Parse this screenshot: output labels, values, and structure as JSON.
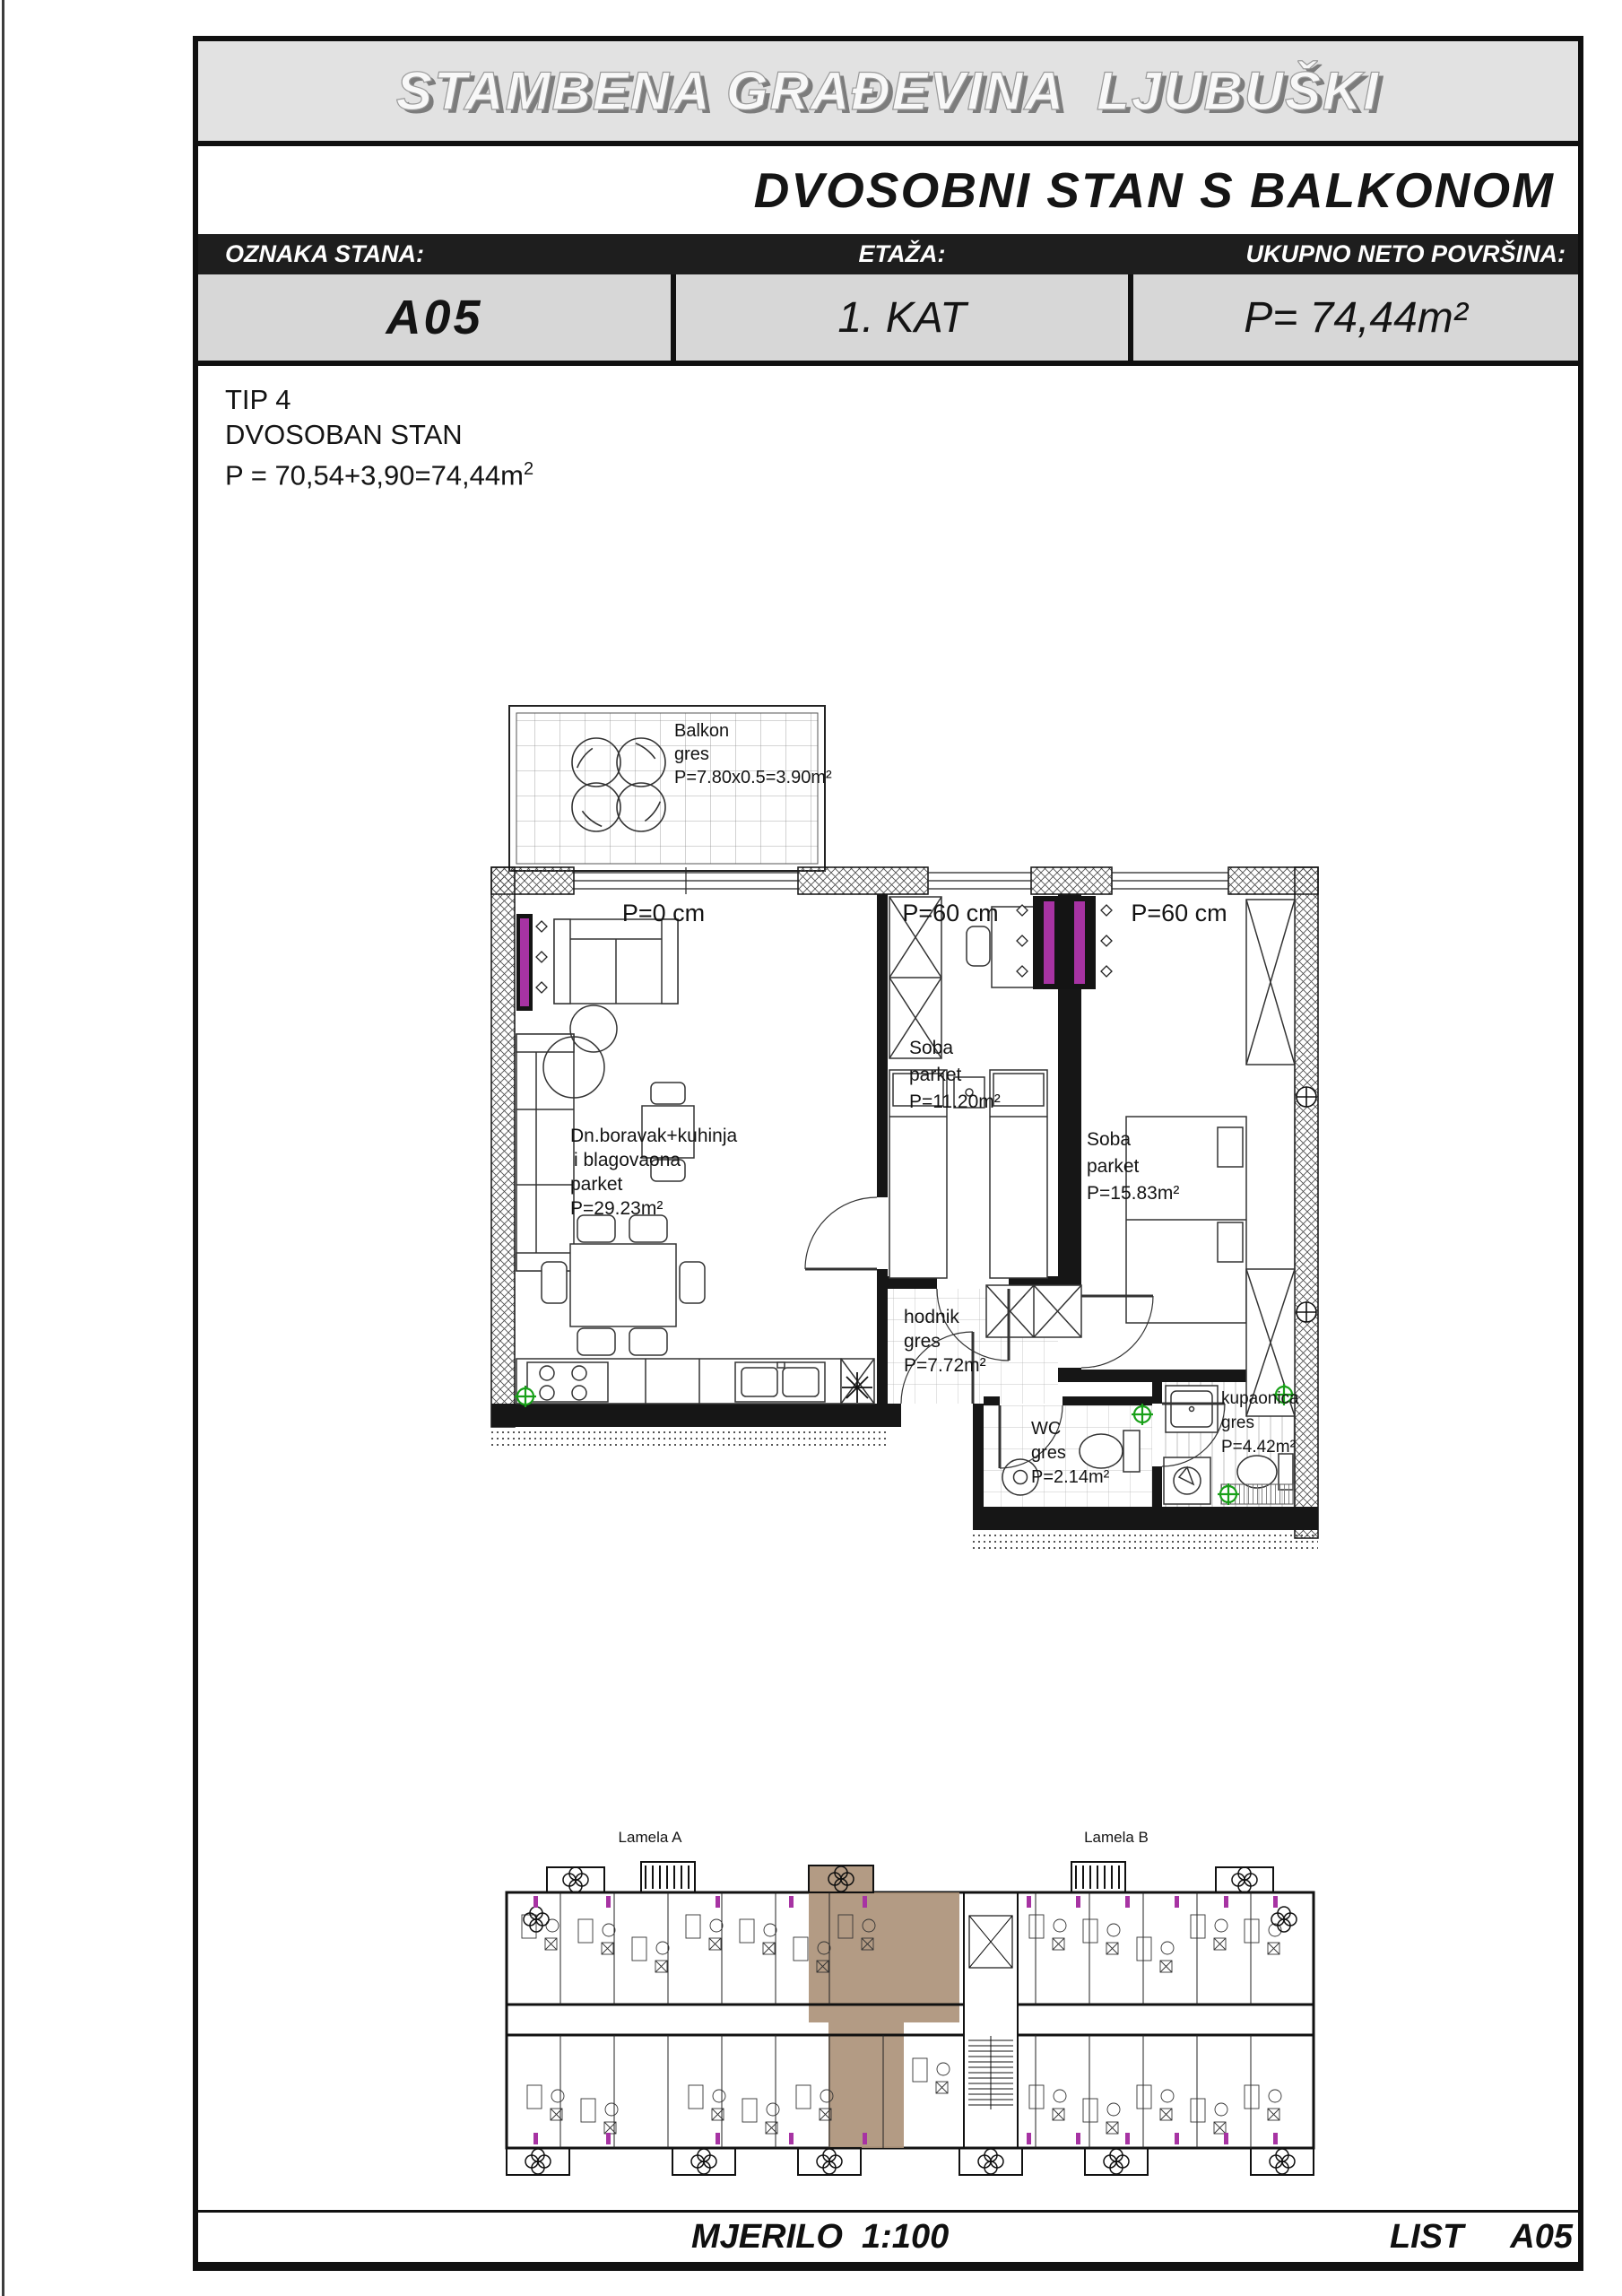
{
  "header": {
    "title": "STAMBENA GRAĐEVINA  LJUBUŠKI",
    "subtitle": "DVOSOBNI STAN S BALKONOM"
  },
  "info": {
    "col1_label": "OZNAKA STANA:",
    "col1_value": "A05",
    "col2_label": "ETAŽA:",
    "col2_value": "1. KAT",
    "col3_label": "UKUPNO NETO POVRŠINA:",
    "col3_value": "P= 74,44m²"
  },
  "type_block": {
    "line1": "TIP 4",
    "line2": "DVOSOBAN STAN",
    "line3": "P = 70,54+3,90=74,44m",
    "line3_sup": "2"
  },
  "plan": {
    "parapet_labels": {
      "p0": "P=0 cm",
      "p60_1": "P=60 cm",
      "p60_2": "P=60 cm"
    },
    "balkon": {
      "name": "Balkon",
      "finish": "gres",
      "area": "P=7.80x0.5=3.90m²"
    },
    "living": {
      "name1": "Dn.boravak+kuhinja",
      "name2": "i blagovaona",
      "finish": "parket",
      "area": "P=29.23m²"
    },
    "soba1": {
      "name": "Soba",
      "finish": "parket",
      "area": "P=11.20m²"
    },
    "soba2": {
      "name": "Soba",
      "finish": "parket",
      "area": "P=15.83m²"
    },
    "hodnik": {
      "name": "hodnik",
      "finish": "gres",
      "area": "P=7.72m²"
    },
    "wc": {
      "name": "WC",
      "finish": "gres",
      "area": "P=2.14m²"
    },
    "kupaonica": {
      "name": "kupaonica",
      "finish": "gres",
      "area": "P=4.42m²"
    }
  },
  "overview": {
    "lamela_a": "Lamela A",
    "lamela_b": "Lamela B"
  },
  "footer": {
    "scale": "MJERILO  1:100",
    "sheet_label": "LIST",
    "sheet_number": "A05"
  },
  "colors": {
    "radiator": "#A733A3",
    "drain": "#18A018",
    "highlight": "#AC9379",
    "title_bg": "#E2E2E2",
    "cell_bg": "#D7D7D7",
    "bar_bg": "#1E1E1E"
  }
}
